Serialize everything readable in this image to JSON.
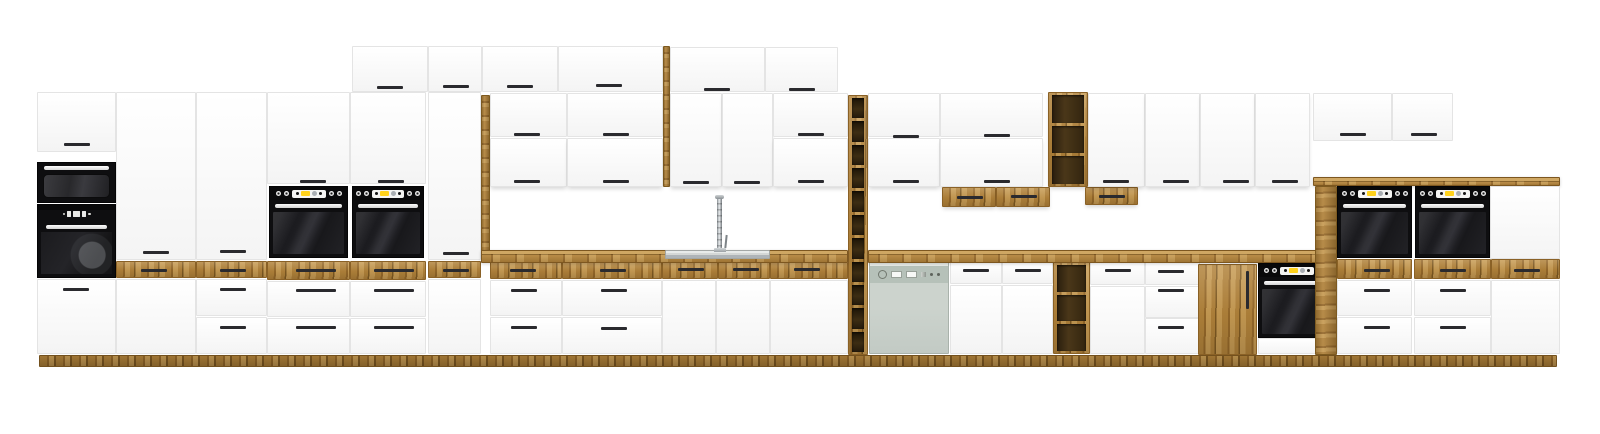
{
  "meta": {
    "title": "White and oak modular kitchen cabinet set with built-in black appliances, wine racks and sink — product render"
  },
  "canvas": {
    "w": 1600,
    "h": 434
  },
  "palette": {
    "background": "#ffffff",
    "white_front": "#fbfbfb",
    "front_border": "#e4e4e4",
    "front_shade": "#f4f4f4",
    "oak": "#b1823a",
    "oak_grain_light": "#c79b53",
    "oak_grain_dark": "#96692a",
    "oak_deep": "#7f5a22",
    "counter_top": "#cfa763",
    "slot_dark": "#3d2d13",
    "handle": "#2a2a2e",
    "appliance_black": "#0e0e10",
    "glass_dark": "#1e1e22",
    "handle_bar": "#f2f2f2",
    "display_yellow": "#ffd21c",
    "display_grey": "#a9aeb2",
    "display_white": "#f4f4f2",
    "dishwasher_body": "#ccd3cd",
    "dishwasher_band": "#b6c1b9",
    "steel_light": "#e8ebea",
    "steel": "#aeb4b8",
    "steel_dark": "#7e8488"
  },
  "scene": {
    "modules": [
      {
        "t": "plinth",
        "x": 39,
        "y": 355,
        "w": 1518,
        "h": 12
      },
      {
        "n": "tall-cabinet-top-door",
        "t": "door",
        "x": 37,
        "y": 92,
        "w": 79,
        "h": 60,
        "hs": [
          [
            76,
            143
          ]
        ]
      },
      {
        "t": "micro",
        "x": 37,
        "y": 162,
        "w": 79,
        "h": 41
      },
      {
        "t": "combi",
        "x": 37,
        "y": 204,
        "w": 79,
        "h": 74
      },
      {
        "t": "door",
        "x": 37,
        "y": 279,
        "w": 79,
        "h": 75,
        "hs": [
          [
            75,
            288
          ]
        ]
      },
      {
        "n": "pantry-door",
        "t": "door",
        "x": 116,
        "y": 92,
        "w": 80,
        "h": 168,
        "hs": [
          [
            155,
            251
          ]
        ]
      },
      {
        "t": "oakdrw",
        "x": 116,
        "y": 261,
        "w": 80,
        "h": 17,
        "hs": [
          [
            153,
            269
          ]
        ]
      },
      {
        "t": "door",
        "x": 116,
        "y": 279,
        "w": 80,
        "h": 75
      },
      {
        "n": "pantry-door",
        "t": "door",
        "x": 196,
        "y": 92,
        "w": 71,
        "h": 168,
        "hs": [
          [
            232,
            250
          ]
        ]
      },
      {
        "t": "oakdrw",
        "x": 196,
        "y": 261,
        "w": 71,
        "h": 17,
        "hs": [
          [
            232,
            269
          ]
        ]
      },
      {
        "t": "drawer",
        "x": 196,
        "y": 279,
        "w": 71,
        "h": 37,
        "hs": [
          [
            232,
            288
          ]
        ]
      },
      {
        "t": "drawer",
        "x": 196,
        "y": 317,
        "w": 71,
        "h": 37,
        "hs": [
          [
            232,
            326
          ]
        ]
      },
      {
        "n": "oven-tower-door",
        "t": "door",
        "x": 267,
        "y": 92,
        "w": 83,
        "h": 92,
        "hs": [
          [
            312,
            180
          ]
        ]
      },
      {
        "t": "oven",
        "x": 269,
        "y": 186,
        "w": 79,
        "h": 72
      },
      {
        "t": "oakdrw",
        "x": 267,
        "y": 261,
        "w": 83,
        "h": 19,
        "hs": [
          [
            315,
            269,
            40
          ]
        ]
      },
      {
        "t": "drawer",
        "x": 267,
        "y": 281,
        "w": 83,
        "h": 36,
        "hs": [
          [
            315,
            289,
            40
          ]
        ]
      },
      {
        "t": "drawer",
        "x": 267,
        "y": 318,
        "w": 83,
        "h": 36,
        "hs": [
          [
            315,
            326,
            40
          ]
        ]
      },
      {
        "n": "oven-tower-door",
        "t": "door",
        "x": 350,
        "y": 92,
        "w": 76,
        "h": 92,
        "hs": [
          [
            390,
            180
          ]
        ]
      },
      {
        "t": "oven",
        "x": 352,
        "y": 186,
        "w": 72,
        "h": 72
      },
      {
        "t": "oakdrw",
        "x": 350,
        "y": 261,
        "w": 76,
        "h": 19,
        "hs": [
          [
            393,
            269,
            40
          ]
        ]
      },
      {
        "t": "drawer",
        "x": 350,
        "y": 281,
        "w": 76,
        "h": 36,
        "hs": [
          [
            393,
            289,
            40
          ]
        ]
      },
      {
        "t": "drawer",
        "x": 350,
        "y": 318,
        "w": 76,
        "h": 36,
        "hs": [
          [
            393,
            326,
            40
          ]
        ]
      },
      {
        "n": "pantry-door",
        "t": "door",
        "x": 428,
        "y": 92,
        "w": 53,
        "h": 168,
        "hs": [
          [
            455,
            252
          ]
        ]
      },
      {
        "t": "oakdrw",
        "x": 428,
        "y": 261,
        "w": 53,
        "h": 17,
        "hs": [
          [
            455,
            269
          ]
        ]
      },
      {
        "t": "door",
        "x": 428,
        "y": 279,
        "w": 53,
        "h": 75
      },
      {
        "n": "top-wall-door",
        "t": "door",
        "x": 352,
        "y": 46,
        "w": 76,
        "h": 46,
        "hs": [
          [
            389,
            86
          ]
        ]
      },
      {
        "n": "top-wall-door",
        "t": "door",
        "x": 428,
        "y": 46,
        "w": 54,
        "h": 46,
        "hs": [
          [
            455,
            85
          ]
        ]
      },
      {
        "n": "top-wall-door",
        "t": "door",
        "x": 482,
        "y": 46,
        "w": 76,
        "h": 46,
        "hs": [
          [
            519,
            85
          ]
        ]
      },
      {
        "n": "top-wall-door",
        "t": "door",
        "x": 558,
        "y": 46,
        "w": 105,
        "h": 46,
        "hs": [
          [
            608,
            84
          ]
        ]
      },
      {
        "t": "oakpanel",
        "x": 663,
        "y": 46,
        "w": 7,
        "h": 141
      },
      {
        "n": "top-wall-door",
        "t": "door",
        "x": 670,
        "y": 47,
        "w": 95,
        "h": 45,
        "hs": [
          [
            716,
            88
          ]
        ]
      },
      {
        "n": "top-wall-door",
        "t": "door",
        "x": 765,
        "y": 47,
        "w": 73,
        "h": 45,
        "hs": [
          [
            801,
            88
          ]
        ]
      },
      {
        "t": "oakpanel",
        "x": 481,
        "y": 95,
        "w": 9,
        "h": 163
      },
      {
        "t": "door",
        "x": 490,
        "y": 93,
        "w": 77,
        "h": 44,
        "hs": [
          [
            526,
            133
          ]
        ]
      },
      {
        "t": "door",
        "x": 490,
        "y": 138,
        "w": 77,
        "h": 49,
        "hs": [
          [
            526,
            180
          ]
        ],
        "sh": 1
      },
      {
        "t": "door",
        "x": 567,
        "y": 93,
        "w": 96,
        "h": 44,
        "hs": [
          [
            615,
            133
          ]
        ]
      },
      {
        "t": "door",
        "x": 567,
        "y": 138,
        "w": 96,
        "h": 49,
        "hs": [
          [
            615,
            180
          ]
        ],
        "sh": 1
      },
      {
        "t": "door",
        "x": 670,
        "y": 93,
        "w": 52,
        "h": 94,
        "hs": [
          [
            695,
            181
          ]
        ],
        "sh": 1
      },
      {
        "t": "door",
        "x": 722,
        "y": 93,
        "w": 51,
        "h": 94,
        "hs": [
          [
            746,
            181
          ]
        ],
        "sh": 1
      },
      {
        "t": "door",
        "x": 773,
        "y": 93,
        "w": 75,
        "h": 44,
        "hs": [
          [
            810,
            133
          ]
        ]
      },
      {
        "t": "door",
        "x": 773,
        "y": 138,
        "w": 75,
        "h": 49,
        "hs": [
          [
            810,
            180
          ]
        ],
        "sh": 1
      },
      {
        "n": "wine-rack-column",
        "t": "rack",
        "x": 848,
        "y": 95,
        "w": 20,
        "h": 260,
        "s": 11
      },
      {
        "t": "door",
        "x": 868,
        "y": 93,
        "w": 72,
        "h": 44,
        "hs": [
          [
            905,
            135
          ]
        ]
      },
      {
        "t": "door",
        "x": 868,
        "y": 138,
        "w": 72,
        "h": 49,
        "hs": [
          [
            905,
            180
          ]
        ],
        "sh": 1
      },
      {
        "t": "door",
        "x": 940,
        "y": 93,
        "w": 103,
        "h": 44,
        "hs": [
          [
            996,
            134
          ]
        ]
      },
      {
        "t": "door",
        "x": 940,
        "y": 138,
        "w": 103,
        "h": 49,
        "hs": [
          [
            996,
            180
          ]
        ],
        "sh": 1
      },
      {
        "n": "hanging-oak-drawer",
        "t": "oakdrw",
        "x": 942,
        "y": 187,
        "w": 54,
        "h": 20,
        "hs": [
          [
            969,
            196
          ]
        ],
        "sh": 1
      },
      {
        "n": "hanging-oak-drawer",
        "t": "oakdrw",
        "x": 996,
        "y": 187,
        "w": 54,
        "h": 20,
        "hs": [
          [
            1023,
            195
          ]
        ],
        "sh": 1
      },
      {
        "n": "open-shelf-wall",
        "t": "shelfu",
        "x": 1048,
        "y": 92,
        "w": 40,
        "h": 95,
        "s": 3,
        "sh": 1
      },
      {
        "n": "hanging-oak-drawer",
        "t": "oakdrw",
        "x": 1085,
        "y": 187,
        "w": 53,
        "h": 18,
        "hs": [
          [
            1111,
            195
          ]
        ],
        "sh": 1
      },
      {
        "t": "door",
        "x": 1088,
        "y": 93,
        "w": 57,
        "h": 94,
        "hs": [
          [
            1115,
            180
          ]
        ],
        "sh": 1
      },
      {
        "t": "door",
        "x": 1145,
        "y": 93,
        "w": 55,
        "h": 94,
        "hs": [
          [
            1175,
            180
          ]
        ],
        "sh": 1
      },
      {
        "t": "door",
        "x": 1200,
        "y": 93,
        "w": 55,
        "h": 94,
        "hs": [
          [
            1235,
            180
          ]
        ],
        "sh": 1
      },
      {
        "t": "door",
        "x": 1255,
        "y": 93,
        "w": 55,
        "h": 94,
        "hs": [
          [
            1284,
            180
          ]
        ],
        "sh": 1
      },
      {
        "t": "oakdrw",
        "x": 490,
        "y": 262,
        "w": 72,
        "h": 17,
        "hs": [
          [
            522,
            269
          ]
        ]
      },
      {
        "t": "oakdrw",
        "x": 562,
        "y": 262,
        "w": 100,
        "h": 17,
        "hs": [
          [
            612,
            269
          ]
        ]
      },
      {
        "t": "oakdrw",
        "x": 662,
        "y": 262,
        "w": 56,
        "h": 17,
        "hs": [
          [
            690,
            268
          ]
        ]
      },
      {
        "t": "oakdrw",
        "x": 718,
        "y": 262,
        "w": 52,
        "h": 17,
        "hs": [
          [
            745,
            268
          ]
        ]
      },
      {
        "t": "oakdrw",
        "x": 770,
        "y": 262,
        "w": 78,
        "h": 17,
        "hs": [
          [
            806,
            268
          ]
        ]
      },
      {
        "t": "drawer",
        "x": 490,
        "y": 280,
        "w": 72,
        "h": 36,
        "hs": [
          [
            523,
            289
          ]
        ]
      },
      {
        "t": "drawer",
        "x": 490,
        "y": 317,
        "w": 72,
        "h": 37,
        "hs": [
          [
            523,
            326
          ]
        ]
      },
      {
        "t": "drawer",
        "x": 562,
        "y": 280,
        "w": 100,
        "h": 36,
        "hs": [
          [
            613,
            289
          ]
        ]
      },
      {
        "t": "drawer",
        "x": 562,
        "y": 317,
        "w": 100,
        "h": 37,
        "hs": [
          [
            613,
            327
          ]
        ]
      },
      {
        "n": "sink-base-door",
        "t": "door",
        "x": 662,
        "y": 280,
        "w": 54,
        "h": 74
      },
      {
        "n": "sink-base-door",
        "t": "door",
        "x": 716,
        "y": 280,
        "w": 54,
        "h": 74
      },
      {
        "t": "door",
        "x": 770,
        "y": 280,
        "w": 78,
        "h": 74
      },
      {
        "t": "dw",
        "x": 869,
        "y": 262,
        "w": 80,
        "h": 92
      },
      {
        "t": "drawer",
        "x": 950,
        "y": 262,
        "w": 52,
        "h": 22,
        "hs": [
          [
            975,
            269
          ]
        ]
      },
      {
        "t": "drawer",
        "x": 1002,
        "y": 262,
        "w": 51,
        "h": 22,
        "hs": [
          [
            1027,
            269
          ]
        ]
      },
      {
        "t": "door",
        "x": 950,
        "y": 285,
        "w": 52,
        "h": 69
      },
      {
        "t": "door",
        "x": 1002,
        "y": 285,
        "w": 51,
        "h": 69
      },
      {
        "n": "open-shelf-base",
        "t": "shelfb",
        "x": 1053,
        "y": 262,
        "w": 37,
        "h": 92,
        "s": 3
      },
      {
        "t": "drawer",
        "x": 1090,
        "y": 262,
        "w": 55,
        "h": 23,
        "hs": [
          [
            1117,
            269
          ]
        ]
      },
      {
        "t": "drawer",
        "x": 1145,
        "y": 262,
        "w": 55,
        "h": 23,
        "hs": [
          [
            1170,
            270
          ]
        ]
      },
      {
        "t": "door",
        "x": 1090,
        "y": 286,
        "w": 55,
        "h": 68
      },
      {
        "t": "drawer",
        "x": 1145,
        "y": 286,
        "w": 55,
        "h": 32,
        "hs": [
          [
            1170,
            289
          ]
        ]
      },
      {
        "t": "drawer",
        "x": 1145,
        "y": 318,
        "w": 55,
        "h": 36,
        "hs": [
          [
            1170,
            326
          ]
        ]
      },
      {
        "n": "oak-base-door",
        "t": "oakdoor",
        "x": 1198,
        "y": 264,
        "w": 59,
        "h": 91,
        "hs": [
          [
            1246,
            289,
            38,
            "v"
          ]
        ]
      },
      {
        "t": "uoven",
        "x": 1258,
        "y": 263,
        "w": 77,
        "h": 75
      },
      {
        "t": "drawer",
        "x": 1258,
        "y": 338,
        "w": 77,
        "h": 16
      },
      {
        "n": "countertop-left",
        "t": "counter",
        "x": 481,
        "y": 250,
        "w": 367,
        "h": 13
      },
      {
        "n": "countertop-right",
        "t": "counter",
        "x": 868,
        "y": 250,
        "w": 452,
        "h": 13
      },
      {
        "t": "sink",
        "x": 665,
        "y": 250,
        "w": 105,
        "h": 9
      },
      {
        "t": "faucet",
        "x": 713,
        "y": 195,
        "w": 15,
        "h": 57
      },
      {
        "n": "top-wall-door",
        "t": "door",
        "x": 1313,
        "y": 93,
        "w": 79,
        "h": 48,
        "hs": [
          [
            1352,
            133
          ]
        ]
      },
      {
        "n": "top-wall-door",
        "t": "door",
        "x": 1392,
        "y": 93,
        "w": 61,
        "h": 48,
        "hs": [
          [
            1423,
            133
          ]
        ]
      },
      {
        "n": "raised-counter-ledge",
        "t": "counter",
        "x": 1313,
        "y": 177,
        "w": 247,
        "h": 9
      },
      {
        "t": "oven",
        "x": 1337,
        "y": 186,
        "w": 75,
        "h": 72
      },
      {
        "t": "oven",
        "x": 1415,
        "y": 186,
        "w": 75,
        "h": 72
      },
      {
        "t": "door",
        "x": 1490,
        "y": 186,
        "w": 70,
        "h": 73
      },
      {
        "t": "oakdrw",
        "x": 1337,
        "y": 259,
        "w": 75,
        "h": 20,
        "hs": [
          [
            1376,
            269
          ]
        ]
      },
      {
        "t": "oakdrw",
        "x": 1414,
        "y": 259,
        "w": 77,
        "h": 20,
        "hs": [
          [
            1452,
            269
          ]
        ]
      },
      {
        "t": "oakdrw",
        "x": 1491,
        "y": 259,
        "w": 69,
        "h": 20,
        "hs": [
          [
            1526,
            269
          ]
        ]
      },
      {
        "t": "drawer",
        "x": 1337,
        "y": 280,
        "w": 75,
        "h": 36,
        "hs": [
          [
            1376,
            289
          ]
        ]
      },
      {
        "t": "drawer",
        "x": 1337,
        "y": 317,
        "w": 75,
        "h": 37,
        "hs": [
          [
            1376,
            326
          ]
        ]
      },
      {
        "t": "drawer",
        "x": 1414,
        "y": 280,
        "w": 77,
        "h": 36,
        "hs": [
          [
            1452,
            289
          ]
        ]
      },
      {
        "t": "drawer",
        "x": 1414,
        "y": 317,
        "w": 77,
        "h": 37,
        "hs": [
          [
            1452,
            326
          ]
        ]
      },
      {
        "t": "door",
        "x": 1491,
        "y": 280,
        "w": 69,
        "h": 74
      },
      {
        "t": "oakpanel",
        "x": 1315,
        "y": 186,
        "w": 22,
        "h": 169
      }
    ]
  }
}
